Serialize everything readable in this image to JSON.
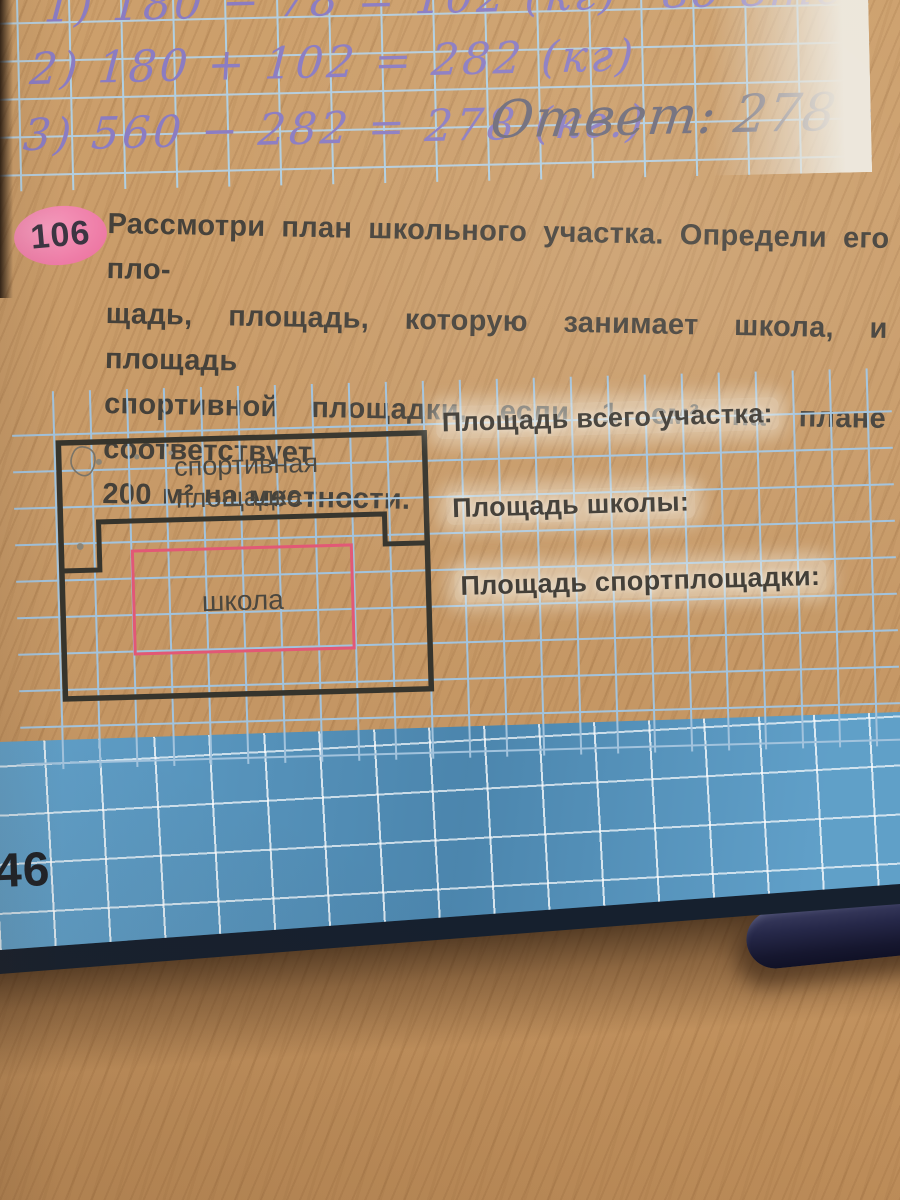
{
  "handwriting": {
    "line1": "1) 180 − 78 = 102 (кг)",
    "line1_note": "во втором",
    "line2": "2) 180 + 102 = 282 (кг)",
    "line3": "3) 560 − 282 = 278 (кг.)",
    "answer": "Ответ: 278 кг."
  },
  "problem": {
    "number": "106",
    "text_lines": [
      "Рассмотри план школьного участка. Определи его пло-",
      "щадь, площадь, которую занимает школа, и площадь",
      "спортивной площадки, если 1 см² на плане соответствует",
      "200 м² на местности."
    ]
  },
  "plan": {
    "sports_label_line1": "спортивная",
    "sports_label_line2": "площадка",
    "school_label": "школа",
    "answer_fields": [
      "Площадь всего участка:",
      "Площадь школы:",
      "Площадь спортплощадки:"
    ]
  },
  "cover": {
    "page_number": "46"
  },
  "colors": {
    "badge_pink": "#ee7ba6",
    "school_outline_pink": "#e25876",
    "plan_outline": "#36342c",
    "grid_blue": "#a2c3dd",
    "cover_blue": "#5b9ac3",
    "ink_violet": "#8b7cc2"
  }
}
